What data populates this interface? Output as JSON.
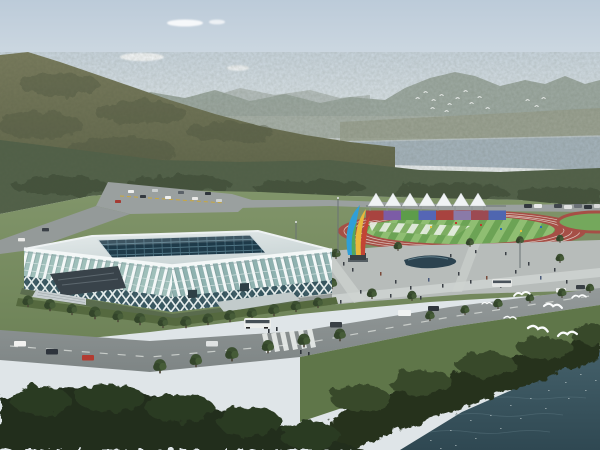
{
  "scene": {
    "title": "Aerial architectural rendering of a riverside sports complex with a white ribbed gymnasium, running track, canopy tents and flying gulls before forested mountains",
    "type": "architectural-rendering",
    "time_of_day": "daytime, hazy",
    "landmarks": [
      "gymnasium with white rib-arch facade and dark glass grid skylight roof",
      "oval running track with striped green infield and multicolor banner wall",
      "row of seven white peaked canopy tents",
      "multicolor ribbon sculpture on plaza",
      "pedestrian plaza with organic pond and walking people",
      "road junction with cars and buses, zebra crosswalk",
      "forested mountain slope and distant hazy ridges",
      "lake band below the far ridge",
      "dark river water with sun glint in the foreground",
      "flock of small white birds near the far mountain",
      "seven white seagulls flying over shoreline trees"
    ],
    "counts": {
      "tents": 7,
      "banner_panels": 8,
      "foreground_gulls": 7,
      "distant_flock_birds": 15
    }
  },
  "palette": {
    "sky_top": "#bccbd9",
    "sky_mid": "#d7e0e6",
    "sky_horizon": "#eceff0",
    "mountain_far": "#9ba69f",
    "mountain_main_hi": "#7a7c5e",
    "mountain_main_lo": "#5e6449",
    "valley_haze": "#9aa190",
    "lake": "#a6b4bd",
    "forest": "#53624a",
    "forest_dark": "#44533e",
    "lawn_hi": "#81956a",
    "lawn_lo": "#6d8257",
    "road": "#8e9494",
    "road_light": "#9aa09f",
    "plaza": "#b7bcba",
    "walkway": "#cfd4d1",
    "track_red": "#a64f46",
    "infield_green": "#6ca355",
    "infield_green_light": "#8fbe72",
    "tent_white": "#f0f3f4",
    "glass_left": "#9fbfba",
    "glass_right": "#8fb2b0",
    "rib_white": "#f4f8f8",
    "roof_hi": "#e6ecec",
    "roof_lo": "#c9d4d5",
    "skylight": "#1e3a49",
    "lattice_dark": "#2f4e58",
    "pond": "#2c4350",
    "water_hi": "#44606a",
    "water_lo": "#2f4852",
    "shore_trees": "#27331f",
    "foreground_trees": "#222d1d",
    "sculpture_blue": "#2f9fd8",
    "sculpture_yellow": "#e9b83c",
    "sculpture_red": "#c24434",
    "sculpture_green": "#58a84c",
    "banner1": "#a8433f",
    "banner2": "#7c5ca6",
    "banner3": "#5d9c4a",
    "banner4": "#5566b5",
    "banner5": "#a8433f",
    "banner6": "#8a7aa8",
    "banner7": "#9c4a52",
    "banner8": "#4f66b0",
    "gull_white": "#fafcfc"
  }
}
